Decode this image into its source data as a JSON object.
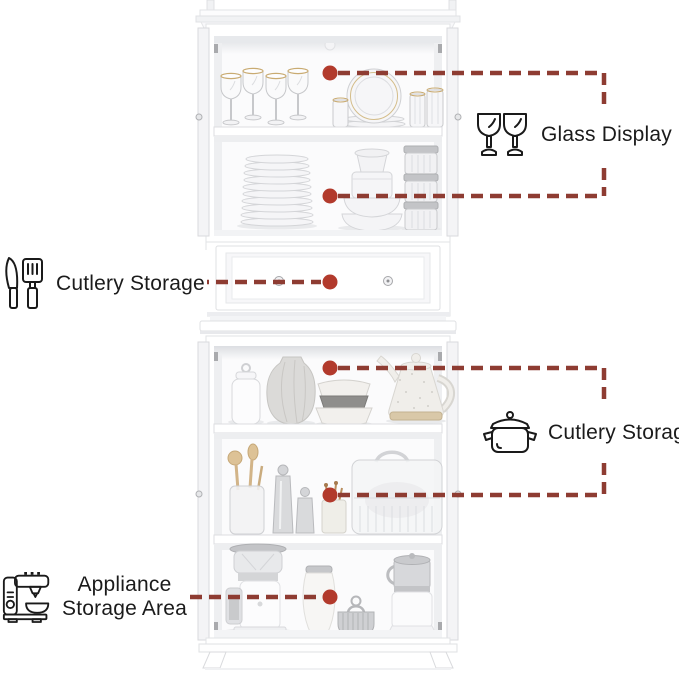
{
  "background": "#ffffff",
  "colors": {
    "callout_line": "#8e3c32",
    "callout_dot": "#b23a2c",
    "label_text": "#1b1b1b",
    "icon_stroke": "#1a1a1a"
  },
  "callouts": {
    "glass_display": {
      "label": "Glass Display",
      "icon": "wine-glasses-icon"
    },
    "cutlery_storage_left": {
      "label": "Cutlery Storage",
      "icon": "knife-spatula-icon"
    },
    "cutlery_storage_right": {
      "label": "Cutlery Storage",
      "icon": "cooking-pot-icon"
    },
    "appliance_storage": {
      "line1": "Appliance",
      "line2": "Storage Area",
      "icon": "stand-mixer-icon"
    }
  }
}
